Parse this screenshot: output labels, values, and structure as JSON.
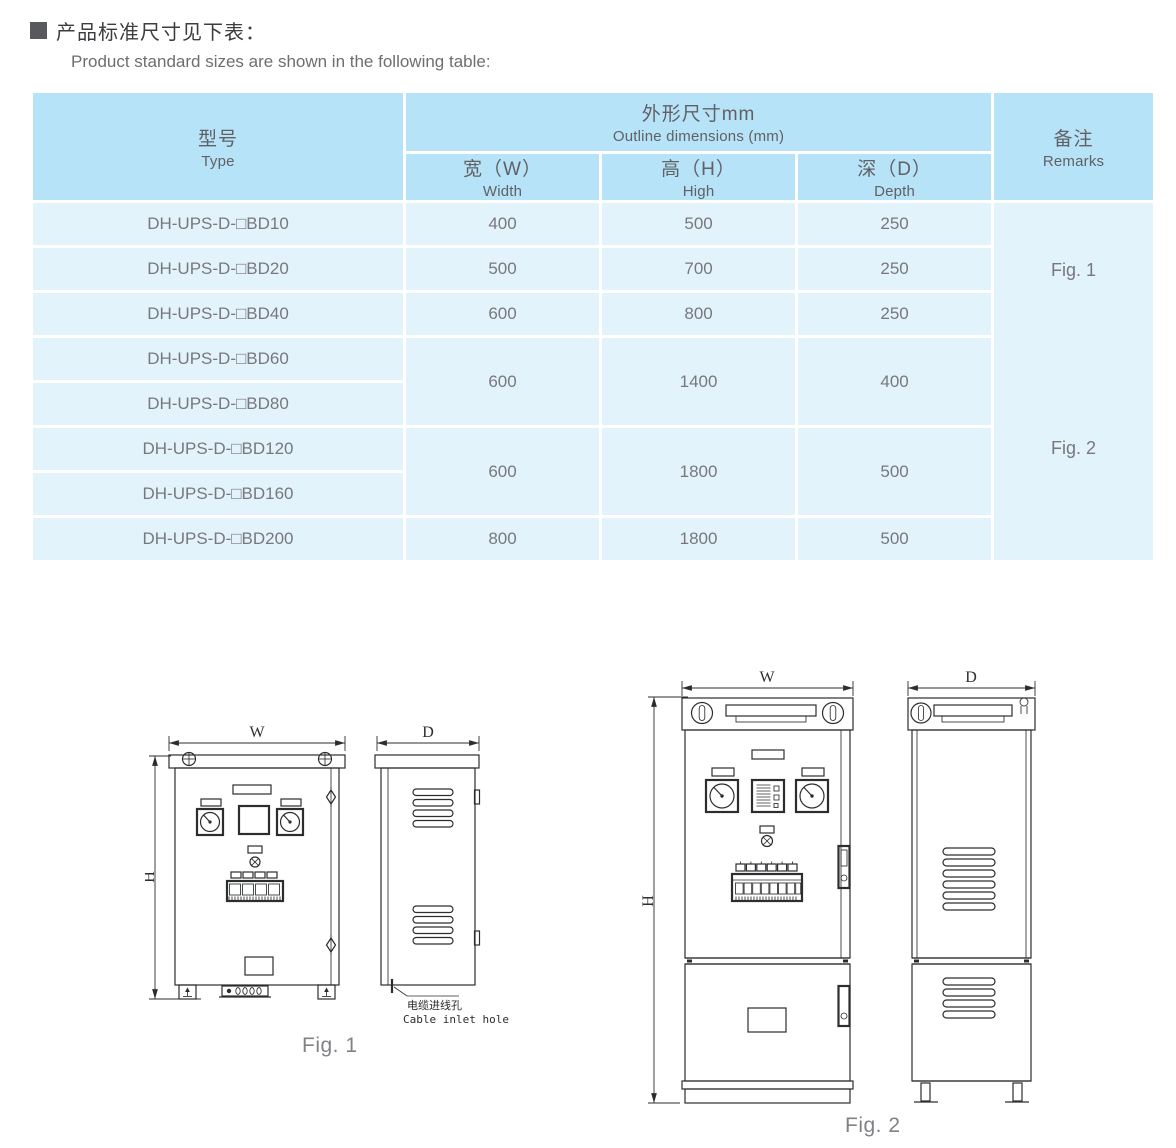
{
  "page": {
    "title_cn": "产品标准尺寸见下表：",
    "title_en": "Product standard sizes are shown in the following table:"
  },
  "table": {
    "header": {
      "type_cn": "型号",
      "type_en": "Type",
      "outline_cn": "外形尺寸mm",
      "outline_en": "Outline dimensions (mm)",
      "w_cn": "宽（W）",
      "w_en": "Width",
      "h_cn": "高（H）",
      "h_en": "High",
      "d_cn": "深（D）",
      "d_en": "Depth",
      "remarks_cn": "备注",
      "remarks_en": "Remarks"
    },
    "rows": [
      {
        "type": "DH-UPS-D-□BD10",
        "w": "400",
        "h": "500",
        "d": "250"
      },
      {
        "type": "DH-UPS-D-□BD20",
        "w": "500",
        "h": "700",
        "d": "250"
      },
      {
        "type": "DH-UPS-D-□BD40",
        "w": "600",
        "h": "800",
        "d": "250"
      },
      {
        "type": "DH-UPS-D-□BD60"
      },
      {
        "type": "DH-UPS-D-□BD80"
      },
      {
        "type": "DH-UPS-D-□BD120"
      },
      {
        "type": "DH-UPS-D-□BD160"
      },
      {
        "type": "DH-UPS-D-□BD200",
        "w": "800",
        "h": "1800",
        "d": "500"
      }
    ],
    "merged": {
      "g1": {
        "w": "600",
        "h": "1400",
        "d": "400"
      },
      "g2": {
        "w": "600",
        "h": "1800",
        "d": "500"
      }
    },
    "remarks": {
      "fig1": "Fig. 1",
      "fig2": "Fig. 2"
    }
  },
  "figures": {
    "fig1": {
      "caption": "Fig. 1",
      "dim_w": "W",
      "dim_h": "H",
      "dim_d": "D",
      "cable_cn": "电缆进线孔",
      "cable_en": "Cable inlet hole"
    },
    "fig2": {
      "caption": "Fig. 2",
      "dim_w": "W",
      "dim_h": "H",
      "dim_d": "D"
    }
  },
  "colors": {
    "table_header_blue": "#b7e3f8",
    "table_row_blue": "#e3f3fc",
    "table_text_gray": "#77787c",
    "drawing_line": "#2c2d2f"
  }
}
